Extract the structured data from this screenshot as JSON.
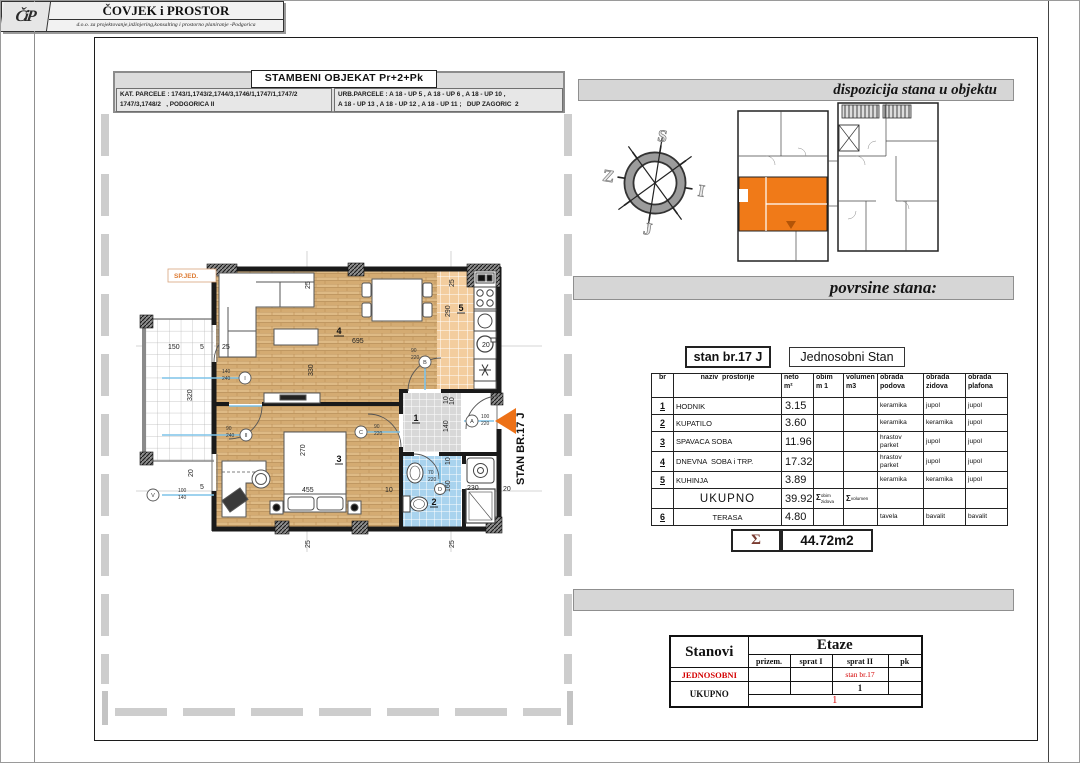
{
  "sheet": {
    "plan_header": {
      "title": "STAMBENI OBJEKAT   Pr+2+Pk",
      "kat_parcele": "KAT. PARCELE : 1743/1,1743/2,1744/3,1746/1,1747/1,1747/2\n1747/3,1748/2   , PODGORICA II",
      "urb_parcele": "URB.PARCELE : A 18 - UP 5 , A 18 - UP 6 , A 18 - UP 10 ,\nA 18 - UP 13 , A 18 - UP 12 , A 18 - UP 11 ;   DUP ZAGORIC  2"
    },
    "title_block": {
      "logo": "ČiP",
      "company": "ČOVJEK i PROSTOR",
      "subtitle": "d.o.o.  za  projektovanje,inžinjering,konsalting i prostorno planiranje -Podgorica"
    },
    "labels": {
      "dispozicija": "dispozicija stana u objektu",
      "povrsine": "povrsine stana:"
    }
  },
  "compass": {
    "n": "S",
    "e": "I",
    "s": "J",
    "w": "Z"
  },
  "plan": {
    "arrow_label": "STAN BR.17 J",
    "sp_jed": "SP.JED.",
    "room_numbers": {
      "hall": "1",
      "bath": "2",
      "bedroom": "3",
      "living": "4",
      "kitchen": "5"
    },
    "dims": {
      "top25": "25",
      "living_width": "695",
      "living_height": "330",
      "kitchen25": "25",
      "kitchen_height": "290",
      "kitchen20": "20",
      "kitchen10": "10",
      "terrace_width": "150",
      "terrace5": "5",
      "wall25": "25",
      "terrace_height": "320",
      "terrace20": "20",
      "left5": "5",
      "hall10": "10",
      "hall_width": "140",
      "bath10": "10",
      "bath_height": "160",
      "bath_width": "230",
      "right20": "20",
      "bed_width": "270",
      "bed_length": "455",
      "bed10": "10",
      "bottom25a": "25",
      "bottom25b": "25"
    },
    "markers": {
      "m1": {
        "letter": "I",
        "a": "140",
        "b": "240"
      },
      "m2": {
        "letter": "II",
        "a": "90",
        "b": "240"
      },
      "mb": {
        "letter": "B",
        "a": "90",
        "b": "220"
      },
      "mc": {
        "letter": "C",
        "a": "90",
        "b": "220"
      },
      "ma": {
        "letter": "A",
        "a": "100",
        "b": "220"
      },
      "md": {
        "letter": "D",
        "a": "70",
        "b": "220"
      },
      "mv": {
        "letter": "V",
        "a": "100",
        "b": "140"
      }
    }
  },
  "apartment_table": {
    "unit_no": "stan br.17 J",
    "unit_type": "Jednosobni Stan",
    "columns": [
      "br",
      "naziv  prostorije",
      "neto\nm²",
      "obim\nm 1",
      "volumen\nm3",
      "obrada\npodova",
      "obrada\nzidova",
      "obrada\nplafona"
    ],
    "rows": [
      {
        "br": "1",
        "name": "HODNIK",
        "neto": "3.15",
        "floor": "keramika",
        "walls": "jupol",
        "ceiling": "jupol"
      },
      {
        "br": "2",
        "name": "KUPATILO",
        "neto": "3.60",
        "floor": "keramika",
        "walls": "keramika",
        "ceiling": "jupol"
      },
      {
        "br": "3",
        "name": "SPAVACA SOBA",
        "neto": "11.96",
        "floor": "hrastov\nparket",
        "walls": "jupol",
        "ceiling": "jupol"
      },
      {
        "br": "4",
        "name": "DNEVNA  SOBA i TRP.",
        "neto": "17.32",
        "floor": "hrastov\nparket",
        "walls": "jupol",
        "ceiling": "jupol"
      },
      {
        "br": "5",
        "name": "KUHINJA",
        "neto": "3.89",
        "floor": "keramika",
        "walls": "keramika",
        "ceiling": "jupol"
      }
    ],
    "total_label": "UKUPNO",
    "total_value": "39.92",
    "sigma": "Σ",
    "obim_note": "obim\nzidova",
    "volumen_note": "volumen",
    "terrace": {
      "br": "6",
      "name": "TERASA",
      "neto": "4.80",
      "floor": "tavela",
      "walls": "bavalit",
      "ceiling": "bavalit"
    },
    "sum_sigma": "Σ",
    "sum_value": "44.72m2"
  },
  "floors_table": {
    "stanovi": "Stanovi",
    "etaze": "Etaze",
    "cols": [
      "prizem.",
      "sprat I",
      "sprat II",
      "pk"
    ],
    "row1_label": "JEDNOSOBNI",
    "row1_sprat2": "stan br.17",
    "row2_label": "UKUPNO",
    "row2_sprat2": "1",
    "row2_total": "1"
  }
}
